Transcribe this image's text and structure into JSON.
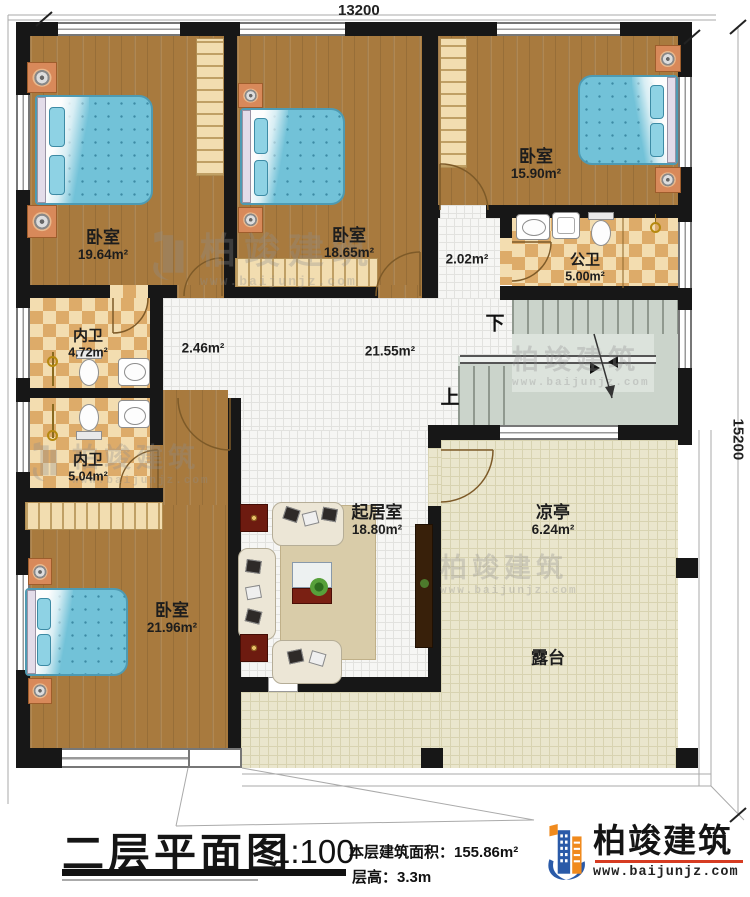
{
  "dimensions": {
    "width_mm": "13200",
    "height_mm": "15200"
  },
  "rooms": {
    "bedroom_tl": {
      "label": "卧室",
      "area": "19.64m²"
    },
    "bedroom_tm": {
      "label": "卧室",
      "area": "18.65m²"
    },
    "bedroom_tr": {
      "label": "卧室",
      "area": "15.90m²"
    },
    "public_bath": {
      "label": "公卫",
      "area": "5.00m²"
    },
    "corridor_small": {
      "area": "2.02m²"
    },
    "inner_bath_1": {
      "label": "内卫",
      "area": "4.72m²"
    },
    "inner_bath_2": {
      "label": "内卫",
      "area": "5.04m²"
    },
    "hall": {
      "area": "21.55m²"
    },
    "hall_west": {
      "area": "2.46m²"
    },
    "living": {
      "label": "起居室",
      "area": "18.80m²"
    },
    "pavilion": {
      "label": "凉亭",
      "area": "6.24m²"
    },
    "bedroom_b": {
      "label": "卧室",
      "area": "21.96m²"
    },
    "terrace": {
      "label": "露台"
    }
  },
  "stairs": {
    "down_label": "下",
    "up_label": "上"
  },
  "title_block": {
    "title": "二层平面图",
    "scale": "1:100",
    "floor_area": "本层建筑面积：155.86m²",
    "floor_height": "层高：3.3m"
  },
  "brand": {
    "name": "柏竣建筑",
    "url": "www.baijunjz.com"
  },
  "watermark": {
    "name": "柏竣建筑",
    "url": "www.baijunjz.com"
  },
  "colors": {
    "wall": "#171717",
    "wood": "#a87a3e",
    "tile_tan": "#ddab69",
    "mattress": "#72c2d8",
    "brand_blue": "#2a5aa8",
    "brand_orange": "#f08a1d",
    "brand_red_rule": "#d63c22"
  }
}
